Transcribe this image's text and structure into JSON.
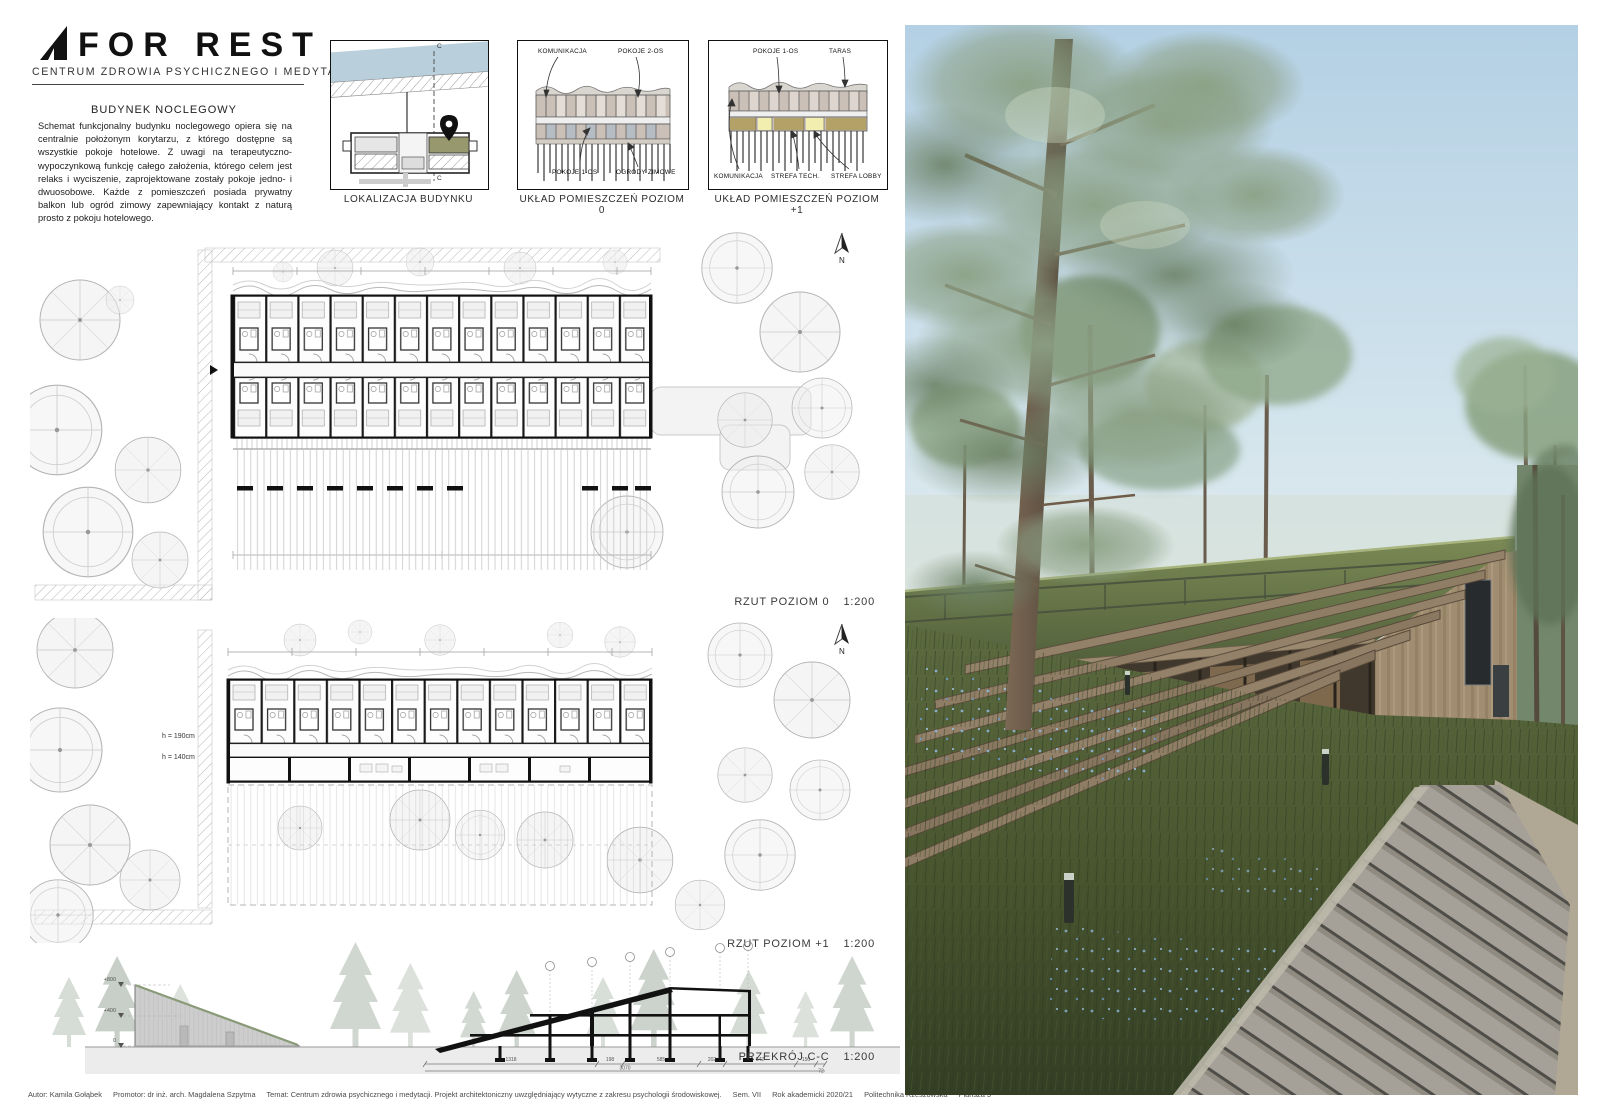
{
  "board": {
    "logo": {
      "title": "FOR REST",
      "subtitle": "CENTRUM ZDROWIA PSYCHICZNEGO I MEDYTACJI"
    },
    "intro": {
      "heading": "BUDYNEK NOCLEGOWY",
      "body": "Schemat funkcjonalny budynku noclegowego opiera się na centralnie położonym korytarzu, z którego dostępne są wszystkie pokoje hotelowe. Z uwagi na terapeutyczno-wypoczynkową funkcję całego założenia, którego celem jest relaks i wyciszenie, zaprojektowane zostały pokoje jedno- i dwuosobowe. Każde z pomieszczeń posiada prywatny balkon lub ogród zimowy zapewniający kontakt z naturą prosto z pokoju hotelowego."
    },
    "diagrams": [
      {
        "caption": "LOKALIZACJA BUDYNKU",
        "section_mark_top": "C",
        "section_mark_bottom": "C"
      },
      {
        "caption": "UKŁAD POMIESZCZEŃ POZIOM 0",
        "labels": {
          "communication": "KOMUNIKACJA",
          "double_rooms": "POKOJE 2-OS",
          "single_rooms": "POKOJE 1-OS",
          "winter_gardens": "OGRODY ZIMOWE"
        }
      },
      {
        "caption": "UKŁAD POMIESZCZEŃ POZIOM +1",
        "labels": {
          "single_rooms": "POKOJE 1-OS",
          "terrace": "TARAS",
          "communication": "KOMUNIKACJA",
          "tech_zone": "STREFA TECH.",
          "lobby_zone": "STREFA LOBBY"
        }
      }
    ],
    "plans": [
      {
        "label": "RZUT POZIOM 0",
        "scale": "1:200",
        "north": "N"
      },
      {
        "label": "RZUT POZIOM +1",
        "scale": "1:200",
        "north": "N",
        "height_note_upper": "h = 190cm",
        "height_note_lower": "h = 140cm"
      }
    ],
    "section": {
      "label": "PRZEKRÓJ C-C",
      "scale": "1:200",
      "levels": [
        "+800",
        "+400",
        "0"
      ],
      "dims": [
        "1318",
        "198",
        "585",
        "202",
        "542",
        "150",
        "72"
      ],
      "total_dim": "3070"
    },
    "footer": {
      "author": "Autor: Kamila Gołąbek",
      "promoter": "Promotor: dr inż. arch. Magdalena Szpytma",
      "subject": "Temat: Centrum zdrowia psychicznego i medytacji. Projekt architektoniczny uwzględniający wytyczne z zakresu psychologii środowiskowej.",
      "semester": "Sem. VII",
      "year": "Rok akademicki 2020/21",
      "university": "Politechnika Rzeszowska",
      "sheet": "Plansza 5"
    }
  },
  "colors": {
    "water_blue": "#b9cfdb",
    "site_highlight_olive": "#98986e",
    "room_tan": "#cbc0b8",
    "corridor_blue_gray": "#b5bcc4",
    "zone_khaki": "#b3a167",
    "zone_yellow": "#f2eeb0",
    "sky": "#bdd6e7",
    "roof_green": "#66754a",
    "meadow_green": "#4d5c38",
    "timber": "#ab957a",
    "boardwalk_gray": "#9c988c",
    "flowers_blue": "#86aed1"
  }
}
